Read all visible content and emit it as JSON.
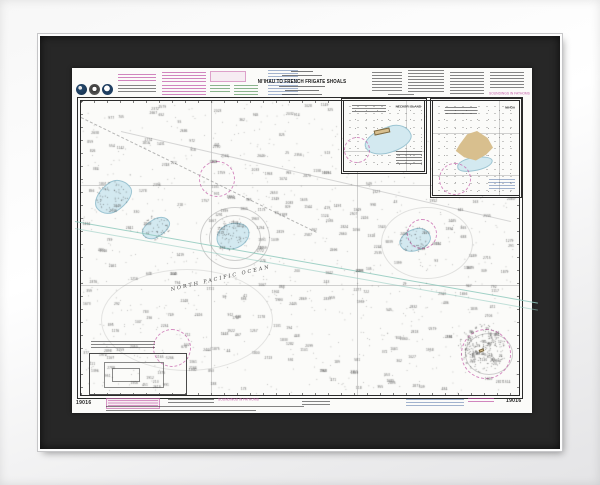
{
  "chart": {
    "title": "NI'IHAU TO FRENCH FRIGATE SHOALS",
    "number": "19016",
    "soundings_note": "SOUNDINGS IN FATHOMS",
    "ocean_label": "NORTH PACIFIC OCEAN",
    "insets": [
      {
        "label": "NECKER ISLAND"
      },
      {
        "label": "NIHOA"
      }
    ]
  },
  "colors": {
    "mat": "#272727",
    "paper": "#fbfbf9",
    "shoal_blue": "#d3e9f0",
    "island_tan": "#d8bf8e",
    "magenta": "#c45ba8",
    "teal": "#8fc9bd"
  }
}
